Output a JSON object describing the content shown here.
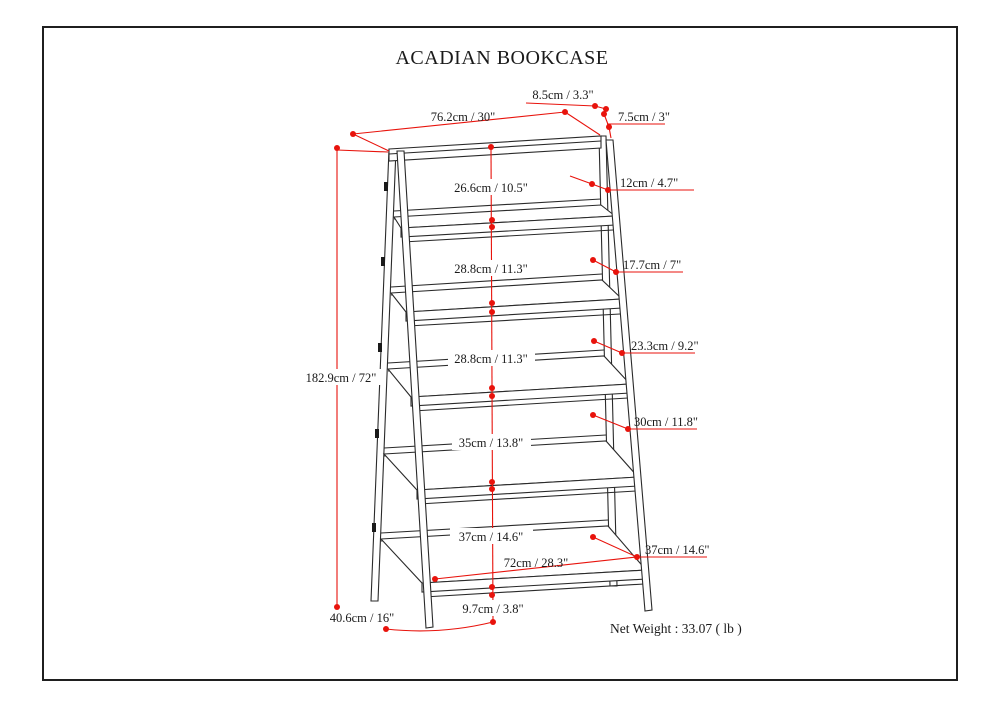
{
  "title": "ACADIAN BOOKCASE",
  "net_weight": "Net Weight : 33.07 ( lb )",
  "colors": {
    "annotation_red": "#e8130c",
    "drawing_black": "#2a2a2a"
  },
  "dimensions": {
    "overall_height": "182.9cm / 72\"",
    "top_width": "76.2cm / 30\"",
    "top_edge": "8.5cm / 3.3\"",
    "side_rail": "7.5cm / 3\"",
    "shelf_gap_1": "26.6cm / 10.5\"",
    "shelf_depth_1": "12cm / 4.7\"",
    "shelf_gap_2": "28.8cm / 11.3\"",
    "shelf_depth_2": "17.7cm / 7\"",
    "shelf_gap_3": "28.8cm / 11.3\"",
    "shelf_depth_3": "23.3cm / 9.2\"",
    "shelf_gap_4": "35cm / 13.8\"",
    "shelf_depth_4": "30cm / 11.8\"",
    "shelf_gap_5": "37cm / 14.6\"",
    "shelf_depth_5": "37cm / 14.6\"",
    "bottom_shelf_width": "72cm / 28.3\"",
    "bottom_clearance": "9.7cm / 3.8\"",
    "base_depth": "40.6cm / 16\""
  }
}
